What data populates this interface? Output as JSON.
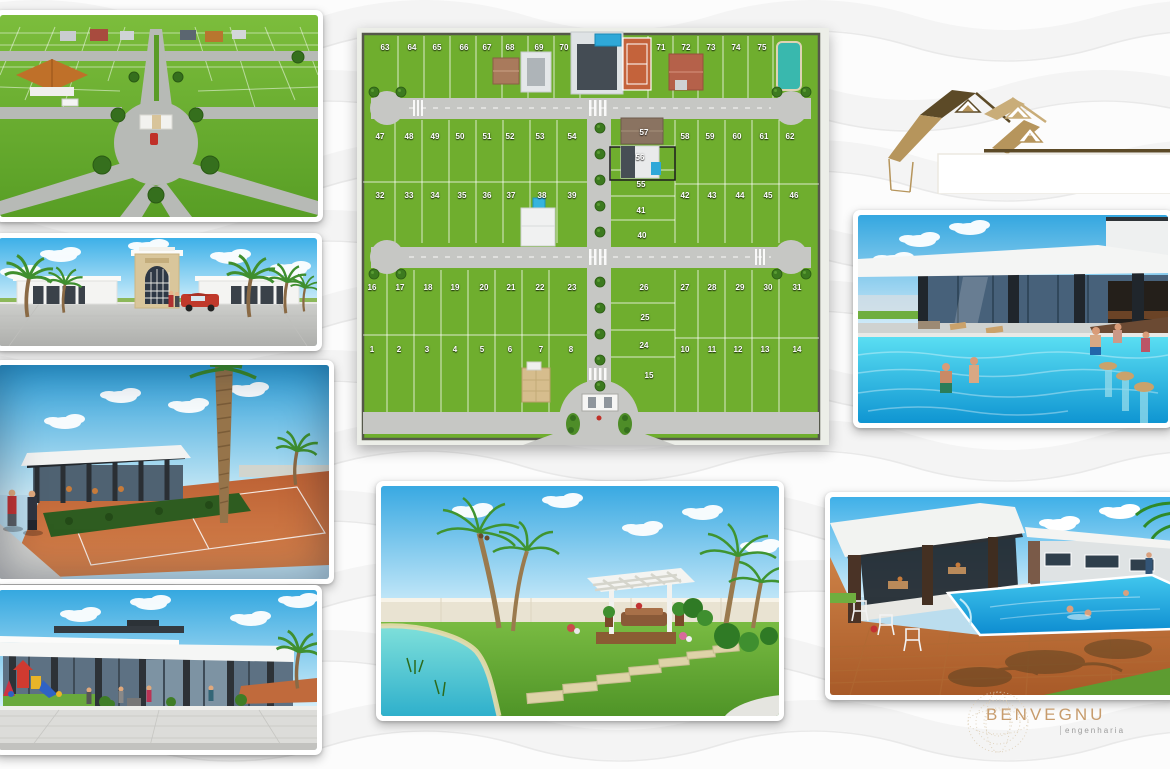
{
  "brand": {
    "name": "BENVEGNU",
    "tagline": "engenharia"
  },
  "colors": {
    "logo_gold": "#b6955c",
    "logo_dark": "#5c4a27",
    "logo_tan": "#c9ad79",
    "brand_text": "#c79c6d",
    "grass": "#6fae2e",
    "road": "#c6c7c4",
    "pool_blue": "#18a6dc",
    "court_clay": "#c4633b",
    "sky_blue": "#3aa9e2"
  },
  "site_plan": {
    "highlighted_lot": "56",
    "lots": [
      {
        "n": "63",
        "x": 28,
        "y": 15
      },
      {
        "n": "64",
        "x": 55,
        "y": 15
      },
      {
        "n": "65",
        "x": 80,
        "y": 15
      },
      {
        "n": "66",
        "x": 107,
        "y": 15
      },
      {
        "n": "67",
        "x": 130,
        "y": 15
      },
      {
        "n": "68",
        "x": 153,
        "y": 15
      },
      {
        "n": "69",
        "x": 182,
        "y": 15
      },
      {
        "n": "70",
        "x": 207,
        "y": 15
      },
      {
        "n": "71",
        "x": 304,
        "y": 15
      },
      {
        "n": "72",
        "x": 329,
        "y": 15
      },
      {
        "n": "73",
        "x": 354,
        "y": 15
      },
      {
        "n": "74",
        "x": 379,
        "y": 15
      },
      {
        "n": "75",
        "x": 405,
        "y": 15
      },
      {
        "n": "47",
        "x": 23,
        "y": 104
      },
      {
        "n": "48",
        "x": 52,
        "y": 104
      },
      {
        "n": "49",
        "x": 78,
        "y": 104
      },
      {
        "n": "50",
        "x": 103,
        "y": 104
      },
      {
        "n": "51",
        "x": 130,
        "y": 104
      },
      {
        "n": "52",
        "x": 153,
        "y": 104
      },
      {
        "n": "53",
        "x": 183,
        "y": 104
      },
      {
        "n": "54",
        "x": 215,
        "y": 104
      },
      {
        "n": "58",
        "x": 328,
        "y": 104
      },
      {
        "n": "59",
        "x": 353,
        "y": 104
      },
      {
        "n": "60",
        "x": 380,
        "y": 104
      },
      {
        "n": "61",
        "x": 407,
        "y": 104
      },
      {
        "n": "62",
        "x": 433,
        "y": 104
      },
      {
        "n": "57",
        "x": 287,
        "y": 100
      },
      {
        "n": "56",
        "x": 283,
        "y": 125
      },
      {
        "n": "55",
        "x": 284,
        "y": 152
      },
      {
        "n": "41",
        "x": 284,
        "y": 178
      },
      {
        "n": "40",
        "x": 285,
        "y": 203
      },
      {
        "n": "32",
        "x": 23,
        "y": 163
      },
      {
        "n": "33",
        "x": 52,
        "y": 163
      },
      {
        "n": "34",
        "x": 78,
        "y": 163
      },
      {
        "n": "35",
        "x": 105,
        "y": 163
      },
      {
        "n": "36",
        "x": 130,
        "y": 163
      },
      {
        "n": "37",
        "x": 154,
        "y": 163
      },
      {
        "n": "38",
        "x": 185,
        "y": 163
      },
      {
        "n": "39",
        "x": 215,
        "y": 163
      },
      {
        "n": "42",
        "x": 328,
        "y": 163
      },
      {
        "n": "43",
        "x": 355,
        "y": 163
      },
      {
        "n": "44",
        "x": 383,
        "y": 163
      },
      {
        "n": "45",
        "x": 411,
        "y": 163
      },
      {
        "n": "46",
        "x": 437,
        "y": 163
      },
      {
        "n": "16",
        "x": 15,
        "y": 255
      },
      {
        "n": "17",
        "x": 43,
        "y": 255
      },
      {
        "n": "18",
        "x": 71,
        "y": 255
      },
      {
        "n": "19",
        "x": 98,
        "y": 255
      },
      {
        "n": "20",
        "x": 127,
        "y": 255
      },
      {
        "n": "21",
        "x": 154,
        "y": 255
      },
      {
        "n": "22",
        "x": 183,
        "y": 255
      },
      {
        "n": "23",
        "x": 215,
        "y": 255
      },
      {
        "n": "26",
        "x": 287,
        "y": 255
      },
      {
        "n": "27",
        "x": 328,
        "y": 255
      },
      {
        "n": "28",
        "x": 355,
        "y": 255
      },
      {
        "n": "29",
        "x": 383,
        "y": 255
      },
      {
        "n": "30",
        "x": 411,
        "y": 255
      },
      {
        "n": "31",
        "x": 440,
        "y": 255
      },
      {
        "n": "25",
        "x": 288,
        "y": 285
      },
      {
        "n": "24",
        "x": 287,
        "y": 313
      },
      {
        "n": "15",
        "x": 292,
        "y": 343
      },
      {
        "n": "1",
        "x": 15,
        "y": 317
      },
      {
        "n": "2",
        "x": 42,
        "y": 317
      },
      {
        "n": "3",
        "x": 70,
        "y": 317
      },
      {
        "n": "4",
        "x": 98,
        "y": 317
      },
      {
        "n": "5",
        "x": 125,
        "y": 317
      },
      {
        "n": "6",
        "x": 153,
        "y": 317
      },
      {
        "n": "7",
        "x": 184,
        "y": 317
      },
      {
        "n": "8",
        "x": 214,
        "y": 317
      },
      {
        "n": "10",
        "x": 328,
        "y": 317
      },
      {
        "n": "11",
        "x": 355,
        "y": 317
      },
      {
        "n": "12",
        "x": 381,
        "y": 317
      },
      {
        "n": "13",
        "x": 408,
        "y": 317
      },
      {
        "n": "14",
        "x": 440,
        "y": 317
      }
    ]
  }
}
